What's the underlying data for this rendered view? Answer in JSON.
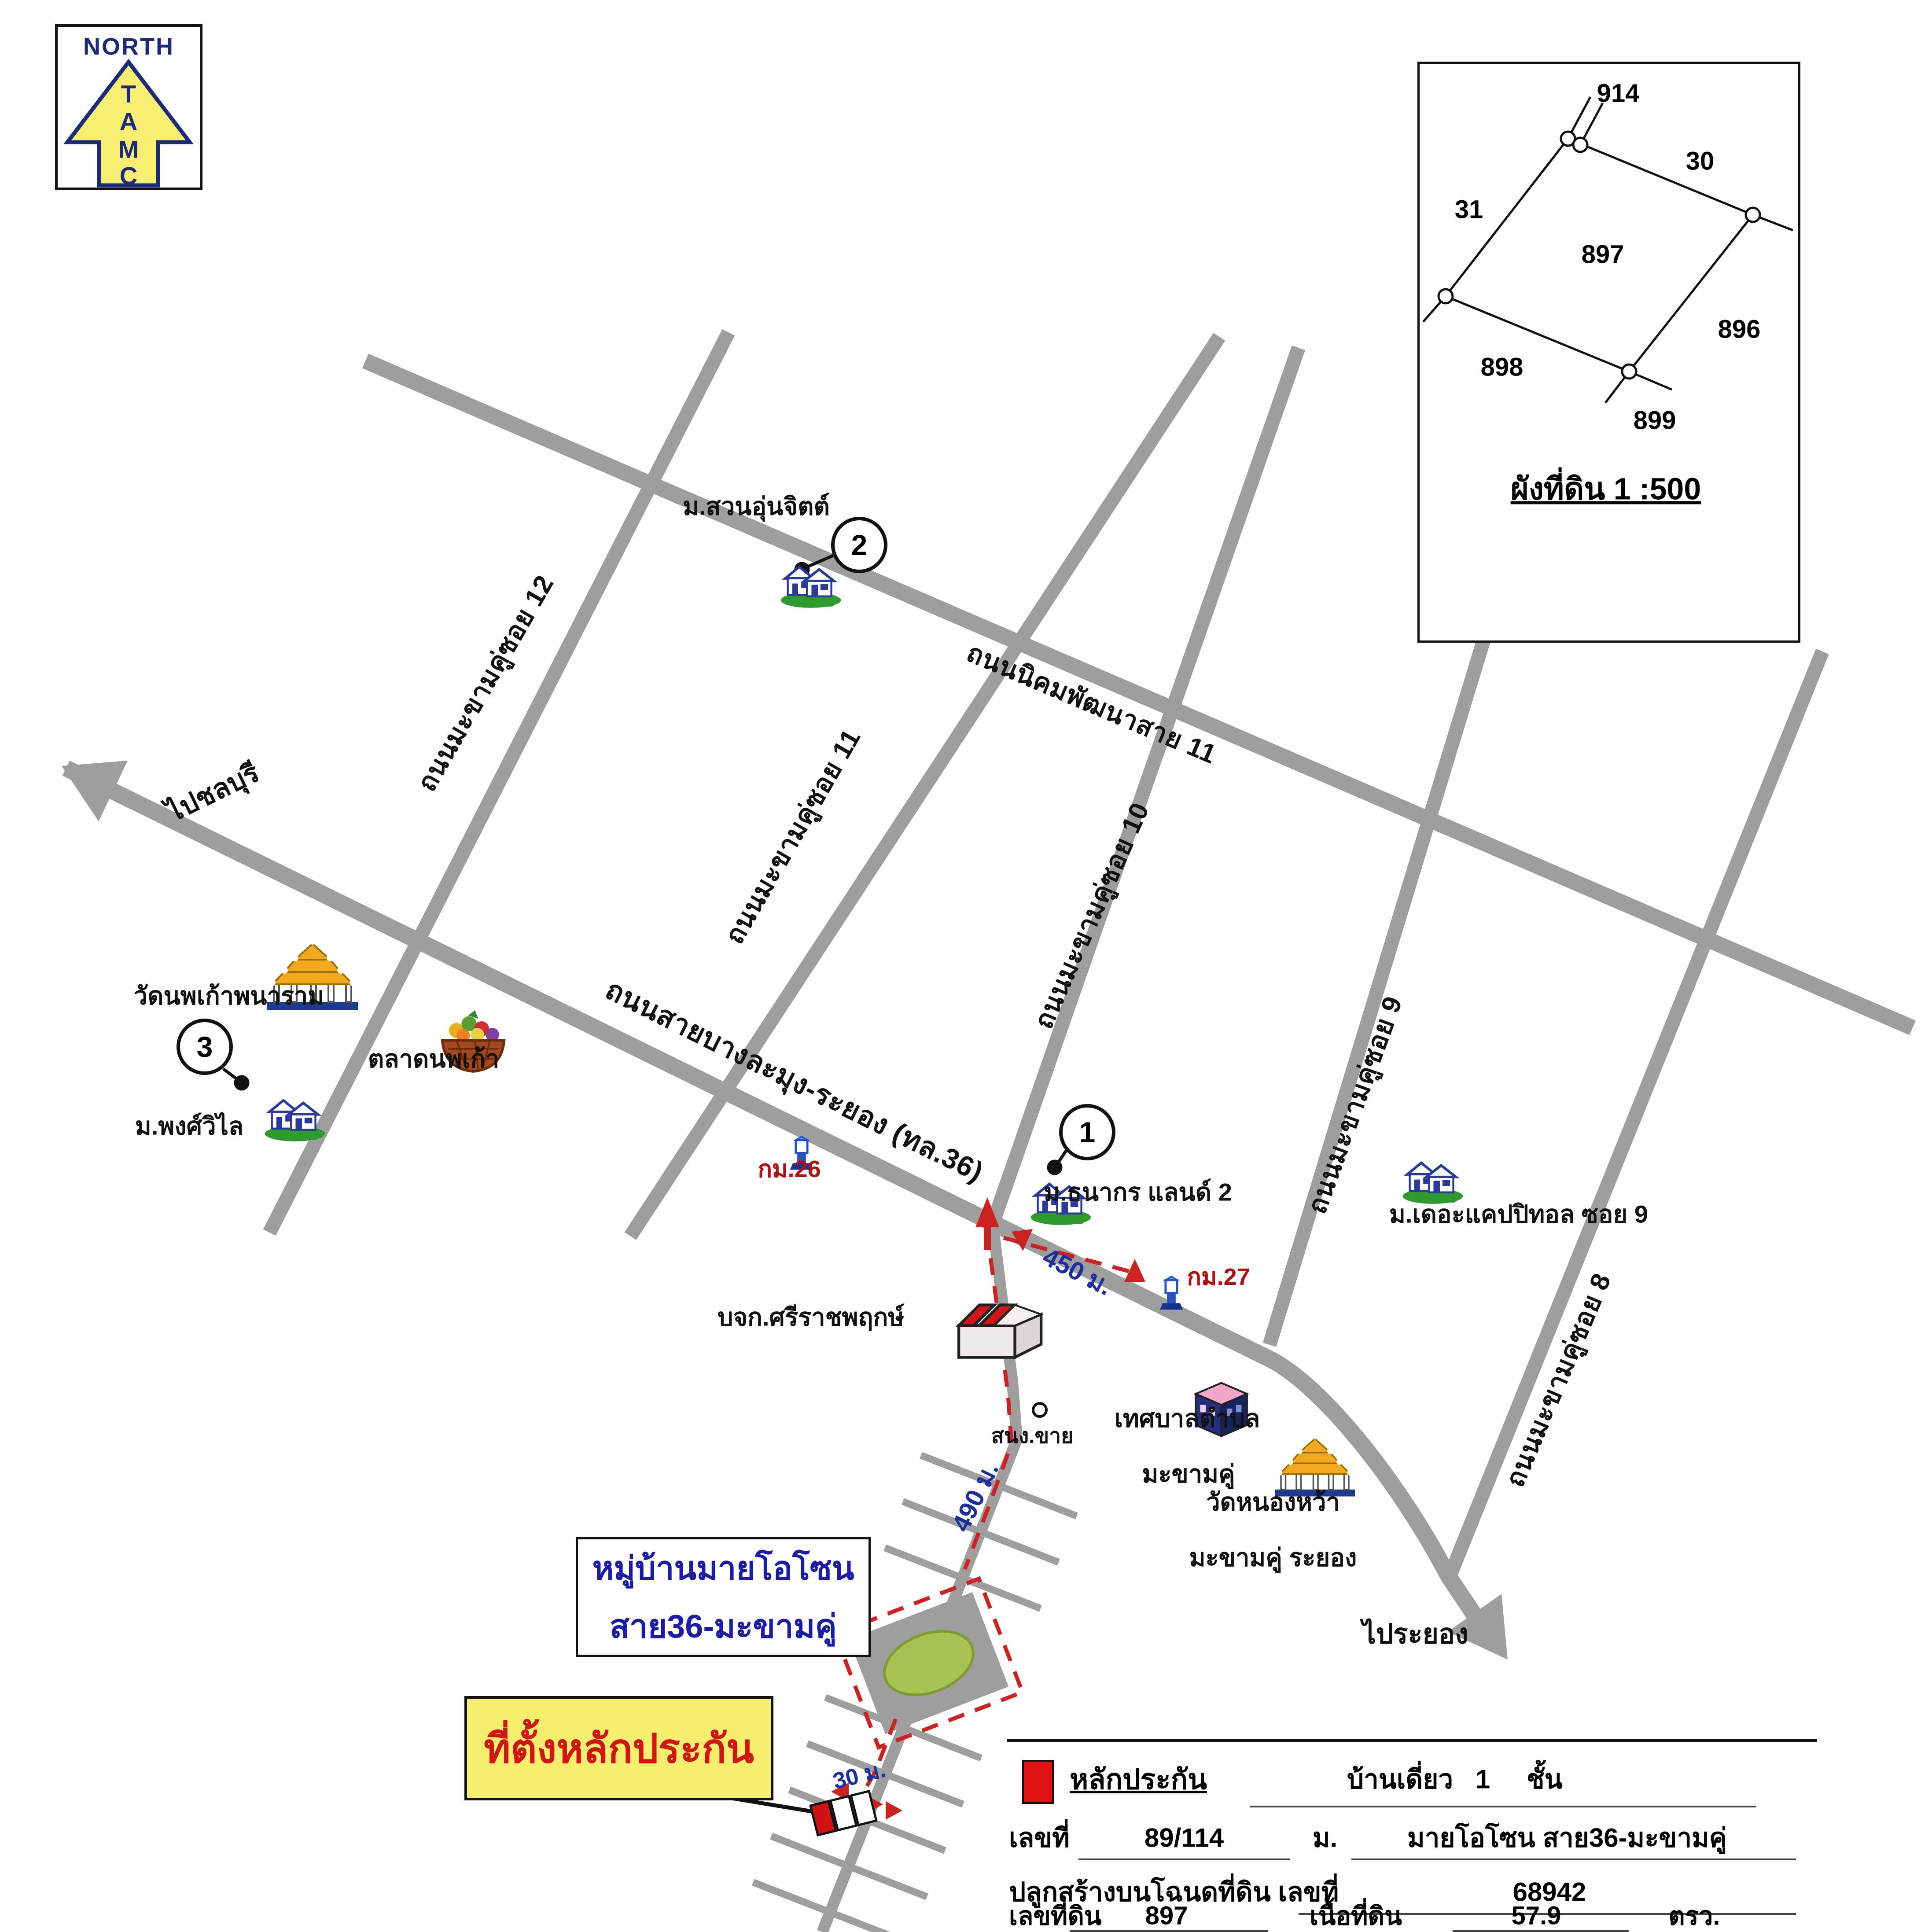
{
  "north_logo": {
    "title": "NORTH",
    "letters": [
      "T",
      "A",
      "M",
      "C"
    ]
  },
  "inset": {
    "plot_914": "914",
    "plot_30": "30",
    "plot_31": "31",
    "plot_897": "897",
    "plot_896": "896",
    "plot_898": "898",
    "plot_899": "899",
    "title": "ผังที่ดิน 1 :500"
  },
  "roads": {
    "nikhom": "ถนนนิคมพัฒนาสาย 11",
    "highway": "ถนนสายบางละมุง-ระยอง (ทล.36)",
    "soi12": "ถนนมะขามคู่ซอย 12",
    "soi11": "ถนนมะขามคู่ซอย 11",
    "soi10": "ถนนมะขามคู่ซอย 10",
    "soi9": "ถนนมะขามคู่ซอย 9",
    "soi8": "ถนนมะขามคู่ซอย 8",
    "to_chonburi": "ไปชลบุรี",
    "to_rayong": "ไประยอง"
  },
  "pois": {
    "suan_unchit": {
      "number": "2",
      "name": "ม.สวนอุ่นจิตต์"
    },
    "thanakorn": {
      "number": "1",
      "name": "ม.ธนากร แลนด์ 2"
    },
    "phongwilai": {
      "number": "3",
      "name": "ม.พงศ์วิไล"
    },
    "wat_noppakao": "วัดนพเก้าพนาราม",
    "talad_noppakao": "ตลาดนพเก้า",
    "capitol": "ม.เดอะแคปปิทอล ซอย 9",
    "sriracha": "บจก.ศรีราชพฤกษ์",
    "tessaban_line1": "เทศบาลตำบล",
    "tessaban_line2": "มะขามคู่",
    "wat_nongwa_line1": "วัดหนองหว้า",
    "wat_nongwa_line2": "มะขามคู่ ระยอง",
    "sales_office": "สนง.ขาย"
  },
  "markers": {
    "km26": "กม.26",
    "km27": "กม.27",
    "d450": "450 ม.",
    "d490": "490 ม.",
    "d30": "30 ม."
  },
  "callouts": {
    "village_line1": "หมู่บ้านมายโอโซน",
    "village_line2": "สาย36-มะขามคู่",
    "site": "ที่ตั้งหลักประกัน"
  },
  "table": {
    "legend": "หลักประกัน",
    "house_type": "บ้านเดี่ยว",
    "floors": "1",
    "floor_unit": "ชั้น",
    "no_label": "เลขที่",
    "no_value": "89/114",
    "moo_label": "ม.",
    "moo_value": "มายโอโซน สาย36-มะขามคู่",
    "deed_label": "ปลูกสร้างบนโฉนดที่ดิน เลขที่",
    "deed_value": "68942",
    "land_no_label": "เลขที่ดิน",
    "land_no_value": "897",
    "area_label": "เนื้อที่ดิน",
    "area_value": "57.9",
    "area_unit": "ตรว."
  }
}
